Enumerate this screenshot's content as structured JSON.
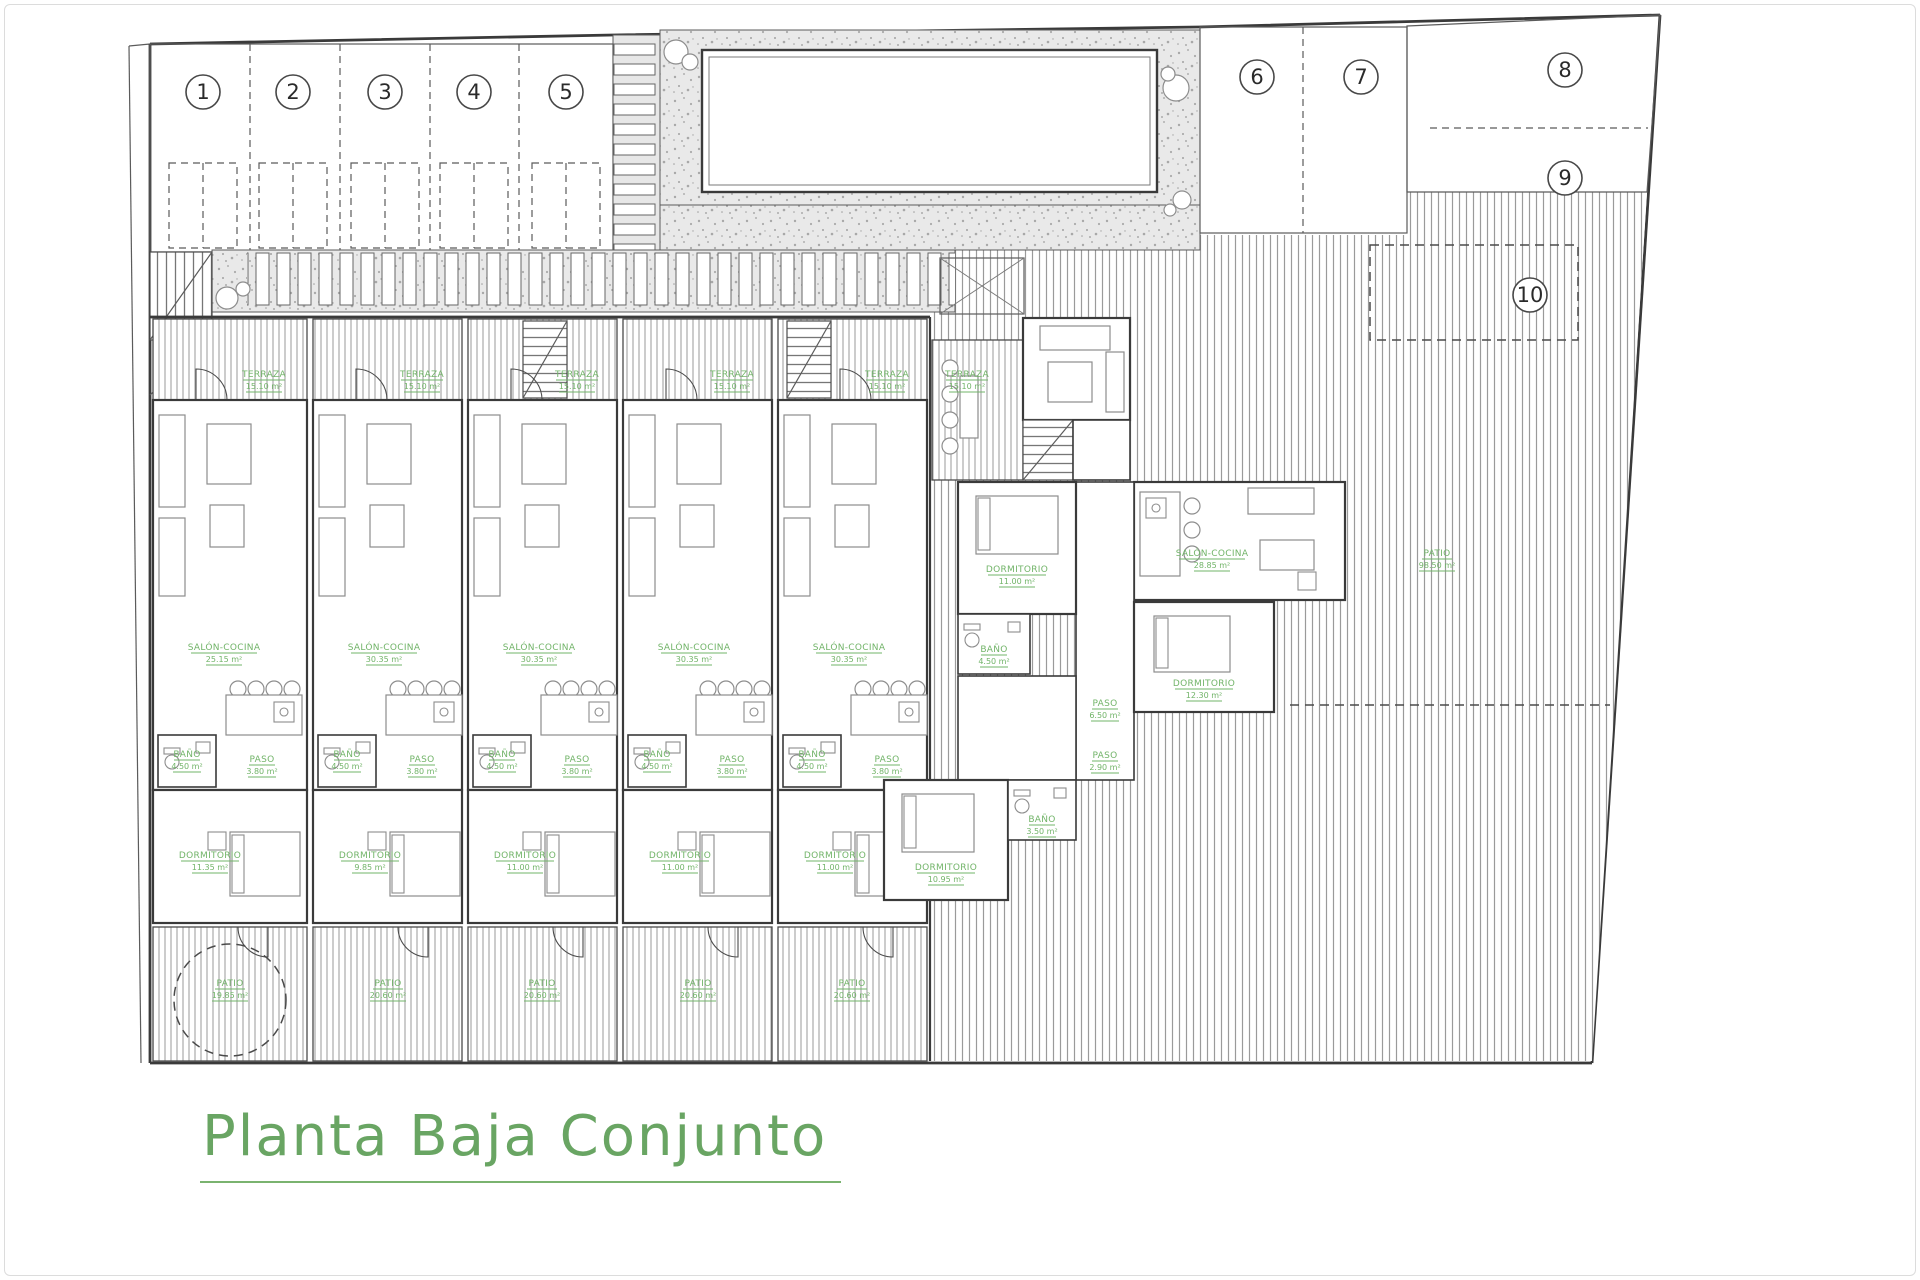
{
  "title": {
    "text": "Planta Baja Conjunto"
  },
  "plots": {
    "numbers": [
      "1",
      "2",
      "3",
      "4",
      "5",
      "6",
      "7",
      "8",
      "9",
      "10"
    ]
  },
  "units": [
    {
      "id": "1",
      "terraza": {
        "name": "TERRAZA",
        "area": "15.10 m²"
      },
      "salon": {
        "name": "SALÓN-COCINA",
        "area": "25.15 m²"
      },
      "bano": {
        "name": "BAÑO",
        "area": "4.50 m²"
      },
      "paso": {
        "name": "PASO",
        "area": "3.80 m²"
      },
      "dormitorio": {
        "name": "DORMITORIO",
        "area": "11.35 m²"
      },
      "patio": {
        "name": "PATIO",
        "area": "19.85 m²"
      }
    },
    {
      "id": "2",
      "terraza": {
        "name": "TERRAZA",
        "area": "15.10 m²"
      },
      "salon": {
        "name": "SALÓN-COCINA",
        "area": "30.35 m²"
      },
      "bano": {
        "name": "BAÑO",
        "area": "4.50 m²"
      },
      "paso": {
        "name": "PASO",
        "area": "3.80 m²"
      },
      "dormitorio": {
        "name": "DORMITORIO",
        "area": "9.85 m²"
      },
      "patio": {
        "name": "PATIO",
        "area": "20.60 m²"
      }
    },
    {
      "id": "3",
      "terraza": {
        "name": "TERRAZA",
        "area": "15.10 m²"
      },
      "salon": {
        "name": "SALÓN-COCINA",
        "area": "30.35 m²"
      },
      "bano": {
        "name": "BAÑO",
        "area": "4.50 m²"
      },
      "paso": {
        "name": "PASO",
        "area": "3.80 m²"
      },
      "dormitorio": {
        "name": "DORMITORIO",
        "area": "11.00 m²"
      },
      "patio": {
        "name": "PATIO",
        "area": "20.60 m²"
      }
    },
    {
      "id": "4",
      "terraza": {
        "name": "TERRAZA",
        "area": "15.10 m²"
      },
      "salon": {
        "name": "SALÓN-COCINA",
        "area": "30.35 m²"
      },
      "bano": {
        "name": "BAÑO",
        "area": "4.50 m²"
      },
      "paso": {
        "name": "PASO",
        "area": "3.80 m²"
      },
      "dormitorio": {
        "name": "DORMITORIO",
        "area": "11.00 m²"
      },
      "patio": {
        "name": "PATIO",
        "area": "20.60 m²"
      }
    },
    {
      "id": "5",
      "terraza": {
        "name": "TERRAZA",
        "area": "15.10 m²"
      },
      "salon": {
        "name": "SALÓN-COCINA",
        "area": "30.35 m²"
      },
      "bano": {
        "name": "BAÑO",
        "area": "4.50 m²"
      },
      "paso": {
        "name": "PASO",
        "area": "3.80 m²"
      },
      "dormitorio": {
        "name": "DORMITORIO",
        "area": "11.00 m²"
      },
      "patio": {
        "name": "PATIO",
        "area": "20.60 m²"
      }
    }
  ],
  "villa": {
    "terraza": {
      "name": "TERRAZA",
      "area": "15.10 m²"
    },
    "salon": {
      "name": "SALÓN-COCINA",
      "area": "28.85 m²"
    },
    "dormitorio1": {
      "name": "DORMITORIO",
      "area": "11.00 m²"
    },
    "bano1": {
      "name": "BAÑO",
      "area": "4.50 m²"
    },
    "paso1": {
      "name": "PASO",
      "area": "6.50 m²"
    },
    "paso2": {
      "name": "PASO",
      "area": "2.90 m²"
    },
    "dormitorio2": {
      "name": "DORMITORIO",
      "area": "12.30 m²"
    },
    "dormitorio3": {
      "name": "DORMITORIO",
      "area": "10.95 m²"
    },
    "bano2": {
      "name": "BAÑO",
      "area": "3.50 m²"
    }
  },
  "garden": {
    "patio": {
      "name": "PATIO",
      "area": "98.50 m²"
    }
  },
  "colors": {
    "label_green": "#72b469",
    "title_green": "#69a563",
    "wall": "#3a3a3a"
  }
}
